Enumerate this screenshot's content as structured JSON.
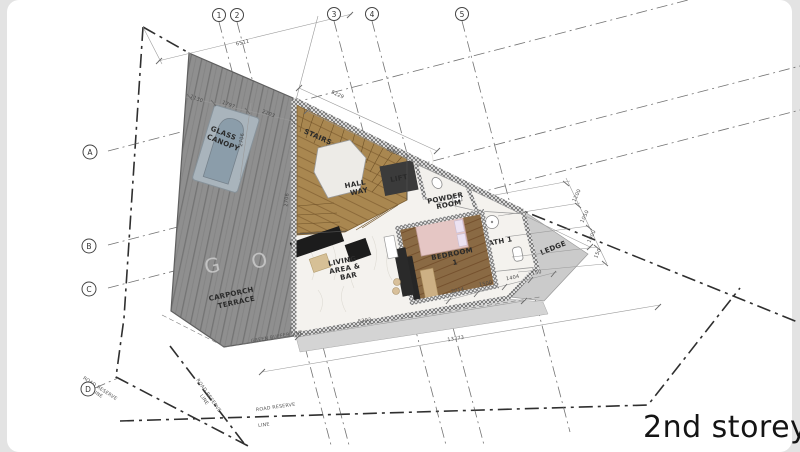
{
  "page": {
    "title": "2nd storey"
  },
  "grid": {
    "cols": [
      "1",
      "2",
      "3",
      "4",
      "5"
    ],
    "rows": [
      "A",
      "B",
      "C",
      "D"
    ]
  },
  "rooms": {
    "glass_canopy": [
      "GLASS",
      "CANOPY"
    ],
    "stairs": [
      "STAIRS"
    ],
    "hall_way": [
      "HALL",
      "WAY"
    ],
    "lift": [
      "LIFT"
    ],
    "powder_room": [
      "POWDER",
      "ROOM"
    ],
    "living_area": [
      "LIVING",
      "AREA &",
      "BAR"
    ],
    "bedroom": [
      "BEDROOM",
      "1"
    ],
    "bath": [
      "BATH 1"
    ],
    "ledge": [
      "LEDGE"
    ],
    "carporch": [
      "CARPORCH",
      "TERRACE"
    ]
  },
  "dims": {
    "top_overall": "6511",
    "edge_1": "1130",
    "edge_2": "1797",
    "edge_3": "2203",
    "hyp_1": "5229",
    "hyp_2": "6867",
    "canopy_left": "2706",
    "stairs_wall": "2706",
    "right_1": "1200",
    "right_2": "1050",
    "right_3": "1000",
    "right_4": "150",
    "bed_1": "2014",
    "bed_2": "1500",
    "bed_3": "1404",
    "bed_4": "150",
    "bottom_1": "5393",
    "bottom_2": "13373"
  },
  "site": {
    "green_buffer": "GREEN BUFFER LINE",
    "road_reserve": [
      "ROAD RESERVE",
      "LINE"
    ]
  },
  "watermark": [
    "G",
    "O"
  ],
  "colors": {
    "deck": "#8f8f8f",
    "stair_wood": "#a98750",
    "bedroom_wood": "#8a6a44",
    "marble": "#f4f2ee",
    "ledge": "#cbcbcb",
    "canopy": "#a9b4bc",
    "accent_dark": "#2e2e2e"
  }
}
